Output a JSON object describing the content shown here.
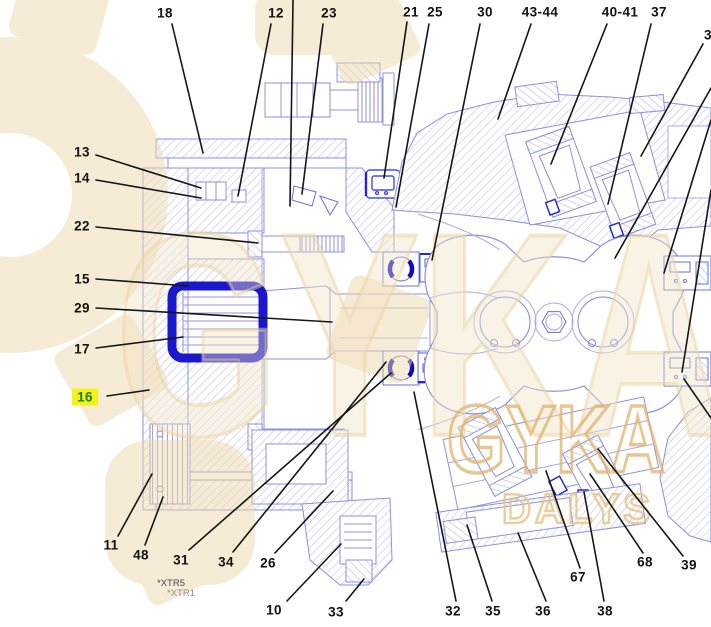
{
  "diagram": {
    "title": "parts-cross-section",
    "selected_callout": "16",
    "colors": {
      "line": "#8c90e0",
      "hatch": "#b9bdf1",
      "leader": "#161616",
      "highlight_box": "#1a17cd",
      "bearing_highlight": "#0d0dc0",
      "selected_bg": "#f2f214",
      "selected_text": "#1f7d1f",
      "watermark": "#eed9ae"
    },
    "watermark": {
      "text_primary": "GYKA",
      "text_secondary": "DALYS",
      "gear_icon": "gear-watermark"
    },
    "notes": [
      "*XTR5",
      "*XTR1"
    ],
    "callouts": [
      {
        "label": "18",
        "lx": 165,
        "ly": 13,
        "line": [
          172,
          24,
          203,
          153
        ]
      },
      {
        "label": "12",
        "lx": 276,
        "ly": 13,
        "line": [
          271,
          24,
          238,
          196
        ]
      },
      {
        "label": "23",
        "lx": 329,
        "ly": 13,
        "line": [
          323,
          24,
          302,
          194
        ]
      },
      {
        "label": "21",
        "lx": 411,
        "ly": 12,
        "line": [
          407,
          22,
          384,
          178
        ]
      },
      {
        "label": "25",
        "lx": 435,
        "ly": 12,
        "line": [
          429,
          24,
          396,
          207
        ]
      },
      {
        "label": "30",
        "lx": 485,
        "ly": 12,
        "line": [
          480,
          24,
          432,
          260
        ]
      },
      {
        "label": "43-44",
        "lx": 540,
        "ly": 12,
        "line": [
          531,
          24,
          498,
          119
        ]
      },
      {
        "label": "40-41",
        "lx": 620,
        "ly": 12,
        "line": [
          607,
          24,
          551,
          164
        ]
      },
      {
        "label": "37",
        "lx": 659,
        "ly": 12,
        "line": [
          651,
          24,
          608,
          204
        ]
      },
      {
        "label": "3",
        "lx": 708,
        "ly": 35,
        "line": [
          703,
          44,
          641,
          156
        ]
      },
      {
        "label": "13",
        "lx": 82,
        "ly": 152,
        "line": [
          96,
          155,
          201,
          188
        ]
      },
      {
        "label": "14",
        "lx": 82,
        "ly": 178,
        "line": [
          96,
          180,
          201,
          198
        ]
      },
      {
        "label": "22",
        "lx": 82,
        "ly": 226,
        "line": [
          96,
          227,
          258,
          243
        ]
      },
      {
        "label": "15",
        "lx": 82,
        "ly": 279,
        "line": [
          96,
          279,
          188,
          286
        ]
      },
      {
        "label": "29",
        "lx": 82,
        "ly": 308,
        "line": [
          96,
          308,
          332,
          322
        ]
      },
      {
        "label": "17",
        "lx": 82,
        "ly": 349,
        "line": [
          96,
          348,
          183,
          337
        ]
      },
      {
        "label": "16",
        "lx": 85,
        "ly": 397,
        "selected": true,
        "line": [
          107,
          396,
          149,
          390
        ]
      },
      {
        "label": "11",
        "lx": 111,
        "ly": 545,
        "line": [
          118,
          536,
          152,
          474
        ]
      },
      {
        "label": "48",
        "lx": 141,
        "ly": 555,
        "line": [
          145,
          545,
          163,
          497
        ]
      },
      {
        "label": "31",
        "lx": 181,
        "ly": 560,
        "line": [
          189,
          550,
          391,
          373
        ]
      },
      {
        "label": "34",
        "lx": 226,
        "ly": 562,
        "line": [
          233,
          552,
          386,
          362
        ]
      },
      {
        "label": "26",
        "lx": 268,
        "ly": 563,
        "line": [
          275,
          553,
          333,
          491
        ]
      },
      {
        "label": "10",
        "lx": 274,
        "ly": 610,
        "line": [
          287,
          601,
          341,
          544
        ]
      },
      {
        "label": "33",
        "lx": 336,
        "ly": 612,
        "line": [
          346,
          601,
          364,
          579
        ]
      },
      {
        "label": "32",
        "lx": 453,
        "ly": 611,
        "line": [
          456,
          601,
          414,
          392
        ]
      },
      {
        "label": "35",
        "lx": 493,
        "ly": 611,
        "line": [
          492,
          601,
          467,
          525
        ]
      },
      {
        "label": "36",
        "lx": 543,
        "ly": 611,
        "line": [
          546,
          601,
          518,
          533
        ]
      },
      {
        "label": "38",
        "lx": 605,
        "ly": 611,
        "line": [
          604,
          601,
          584,
          492
        ]
      },
      {
        "label": "67",
        "lx": 578,
        "ly": 577,
        "line": [
          580,
          568,
          546,
          471
        ]
      },
      {
        "label": "68",
        "lx": 645,
        "ly": 562,
        "line": [
          643,
          553,
          590,
          474
        ]
      },
      {
        "label": "39",
        "lx": 689,
        "ly": 565,
        "line": [
          683,
          556,
          598,
          449
        ]
      }
    ],
    "extra_leader_lines": [
      [
        293,
        0,
        290,
        206
      ],
      [
        711,
        88,
        615,
        258
      ],
      [
        711,
        120,
        664,
        273
      ],
      [
        711,
        190,
        682,
        372
      ],
      [
        711,
        418,
        684,
        379
      ]
    ]
  }
}
